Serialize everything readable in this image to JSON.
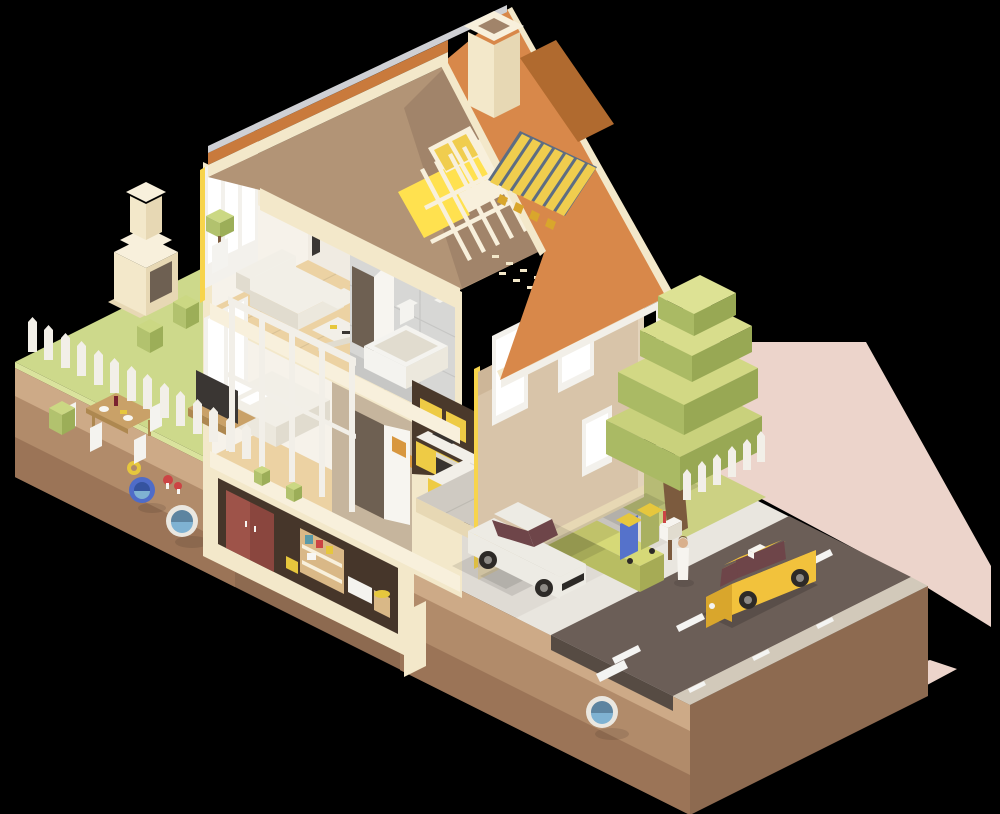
{
  "canvas": {
    "width": 1000,
    "height": 814
  },
  "scene": {
    "type": "isometric-low-poly-cutaway-illustration",
    "subject": "Two-story house cross-section with attic, basement, garden, driveway and street",
    "elements": [
      "orange gable roof with chimney and rooftop solar collector",
      "attic cutaway with timber rafters and yellow insulation",
      "upper-floor living room with sofa, coffee table, media wall, speaker and potted plant",
      "upper-floor bathroom with bathtub, toilet and sink",
      "ground-floor bedroom with bed, TV on pallet stand and open door",
      "ground-floor kitchen with yellow cabinets, oven, fridge, island and bar stools",
      "basement cellar with red doors, storage shelf, boxes and barrel",
      "garden with picket fence, bushes, dining table, chairs and outdoor fireplace",
      "soil cross-section with blue and white utility pipes",
      "driveway with white car and hedge",
      "street with asphalt road, lane markings and yellow taxi",
      "blocky green tree, trash bins, mailbox and pedestrian",
      "pink cast shadow on the ground"
    ]
  },
  "palette": {
    "shadow_pink": "#ecd4cb",
    "grass": "#cdd98b",
    "grass_light": "#dae39d",
    "soil_top": "#cdaa87",
    "soil_mid": "#b18b6a",
    "soil_dark": "#9b7457",
    "soil_face_se": "#8d6a50",
    "fence_white": "#f2efe8",
    "bush_top": "#cbd883",
    "bush_left": "#b2c26e",
    "bush_right": "#9cae58",
    "cream": "#f3e8ca",
    "cream_dark": "#e7d8b4",
    "cream_light": "#f8f0dc",
    "ridge_cap": "#cfd0d4",
    "roof_orange": "#d8884a",
    "roof_sliver": "#c97a3c",
    "roof_shadow": "#b06a2f",
    "attic_tan": "#b29476",
    "attic_dark": "#a1846a",
    "insul_yellow": "#f7d44c",
    "insul_bright": "#ffe14f",
    "panel_frame": "#5d6d83",
    "panel_yellow": "#f0cd4e",
    "wall_white": "#f0ebe2",
    "wall_light": "#f6f2ea",
    "window_white": "#ffffff",
    "frame_white": "#f3f1ec",
    "ceiling": "#f4ecd9",
    "floor_tan": "#ecd2a3",
    "floor_gray": "#cfcac2",
    "sofa_white": "#f2efe7",
    "sofa_mid": "#ece8dd",
    "sofa_shadow": "#e1dccf",
    "tv_dark": "#3a3633",
    "wood": "#c9a168",
    "wood_dark": "#ae8850",
    "wall_tan": "#c6b59d",
    "door_white": "#f7f5f0",
    "door_gap": "#6e6052",
    "picture_orange": "#d8973f",
    "bath_tile": "#d7d7d5",
    "bath_tile_dark": "#c7c7c5",
    "fixture_white": "#f4f3ef",
    "kitchen_yellow": "#eecb45",
    "kitchen_yellow_dark": "#d9b334",
    "counter_white": "#f2efe8",
    "appliance": "#dcd7cc",
    "oven_dark": "#38332f",
    "kitchen_back": "#4a392b",
    "basement_dark": "#46362a",
    "cellar_red": "#9e5349",
    "cellar_red_dark": "#8a463e",
    "shelf_wood": "#d9b887",
    "item_teal": "#5a9aa8",
    "facade_tan": "#d8c4a9",
    "facade_light": "#e3d3bb",
    "facade_shade": "#cdb698",
    "drive_gray": "#dfdbd4",
    "sidewalk": "#e9e6df",
    "asphalt": "#6b5e57",
    "asphalt_side": "#564b43",
    "road_white": "#f4f4f2",
    "shoulder": "#d2c9ba",
    "hedge_top": "#d6d977",
    "hedge_left": "#b8bd62",
    "hedge_right": "#a6ab55",
    "lawn": "#ccd183",
    "tree_top1": "#c9d17c",
    "tree_top2": "#d2d884",
    "tree_top3": "#d8dd8c",
    "tree_top4": "#dde294",
    "tree_left": "#aaba64",
    "tree_right": "#98a854",
    "trunk": "#7c5b3e",
    "taxi_yellow": "#f2c23c",
    "taxi_dark": "#d9a62c",
    "car_white": "#edebe4",
    "glass_dark": "#6e4549",
    "wheel_dark": "#2d2a27",
    "wheel_hub": "#8d8a85",
    "bin_blue": "#5572cb",
    "bin_olive": "#a9b061",
    "lid_yellow": "#e6c73d",
    "mailbox_white": "#f6f4ef",
    "flag_red": "#cc4444",
    "skin": "#d9b08c",
    "pipe_blue": "#4f6cc8",
    "pipe_blue_dark": "#35539f",
    "pipe_white": "#eae7e0",
    "pipe_inner": "#5d84a0",
    "water_blue": "#7fb2d2",
    "plate_white": "#f7f6f2",
    "wine_red": "#7a2230"
  }
}
